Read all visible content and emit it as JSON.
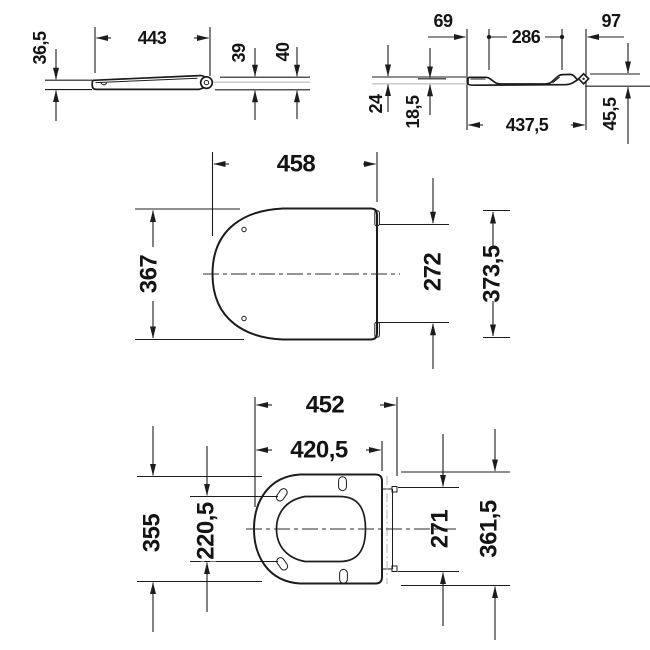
{
  "drawing": {
    "subject": "toilet-seat-technical-drawing",
    "colors": {
      "line": "#1c1c1c",
      "reference_line": "#c6c6c6",
      "text": "#141414",
      "background": "#ffffff"
    }
  },
  "views": {
    "side_view_closed": {
      "title": "seat-with-lid-closed-side-view",
      "dims": {
        "length": "443",
        "front_height": "36,5",
        "rear_height_inner": "39",
        "rear_height_outer": "40"
      }
    },
    "side_view_ring": {
      "title": "seat-ring-side-view",
      "dims": {
        "front_lip": "69",
        "middle": "286",
        "rear": "97",
        "front_height": "24",
        "dish_depth": "18,5",
        "overall_length": "437,5",
        "rear_height": "45,5"
      }
    },
    "top_view_lid": {
      "title": "lid-top-view",
      "dims": {
        "length": "458",
        "width": "367",
        "hinge_width": "272",
        "overall_width": "373,5"
      }
    },
    "top_view_ring": {
      "title": "seat-ring-top-view",
      "dims": {
        "overall_length": "452",
        "ring_length": "420,5",
        "width": "355",
        "opening_width": "220,5",
        "hinge_width": "271",
        "overall_width": "361,5"
      }
    }
  }
}
